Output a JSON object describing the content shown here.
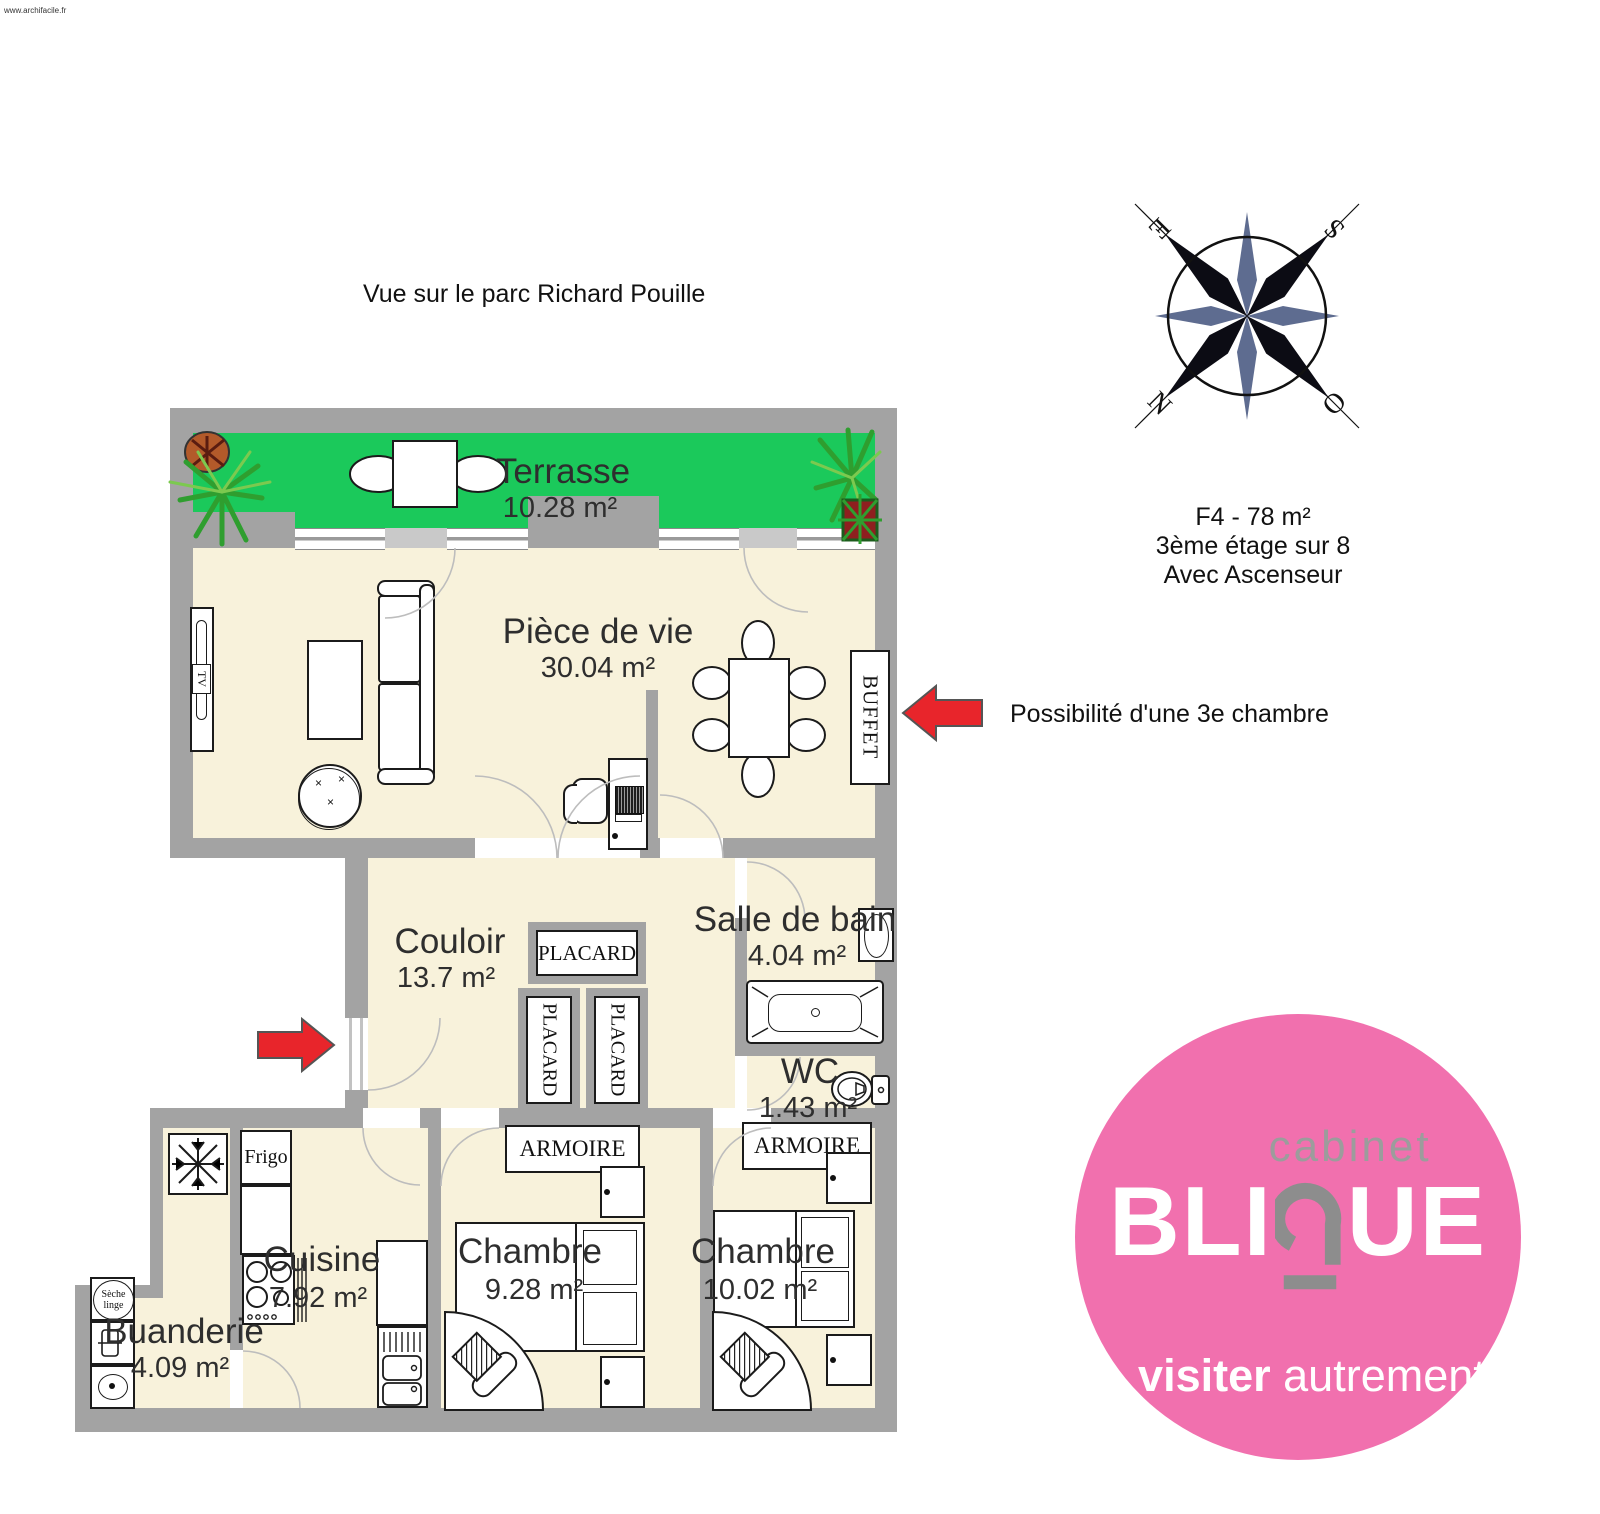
{
  "watermark": "www.archifacile.fr",
  "view_note": "Vue sur le parc Richard Pouille",
  "info": {
    "line1": "F4 - 78 m²",
    "line2": "3ème étage sur 8",
    "line3": "Avec Ascenseur"
  },
  "annotation": {
    "text": "Possibilité d'une 3e chambre"
  },
  "compass": {
    "e": "E",
    "s": "S",
    "n": "N",
    "o": "O"
  },
  "rooms": {
    "terrasse": {
      "name": "Terrasse",
      "area": "10.28 m²"
    },
    "piece_de_vie": {
      "name": "Pièce de vie",
      "area": "30.04 m²"
    },
    "couloir": {
      "name": "Couloir",
      "area": "13.7 m²"
    },
    "salle_de_bain": {
      "name": "Salle de bain",
      "area": "4.04 m²"
    },
    "wc": {
      "name": "WC",
      "area": "1.43 m²"
    },
    "cuisine": {
      "name": "Cuisine",
      "area": "7.92 m²"
    },
    "chambre1": {
      "name": "Chambre",
      "area": "9.28 m²"
    },
    "chambre2": {
      "name": "Chambre",
      "area": "10.02 m²"
    },
    "buanderie": {
      "name": "Buanderie",
      "area": "4.09 m²"
    }
  },
  "furniture": {
    "buffet": "BUFFET",
    "placard": "PLACARD",
    "armoire": "ARMOIRE",
    "frigo": "Frigo",
    "seche_line1": "Sèche",
    "seche_line2": "linge",
    "tv": "TV"
  },
  "logo": {
    "cabinet": "cabinet",
    "brand_left": "BLI",
    "brand_right": "UE",
    "tagline_bold": "visiter",
    "tagline_light": "autrement"
  },
  "colors": {
    "wall": "#A3A3A3",
    "floor": "#F8F2DB",
    "terrace_green": "#1BC95B",
    "logo_pink": "#F170AE",
    "arrow_red": "#E8252B"
  }
}
